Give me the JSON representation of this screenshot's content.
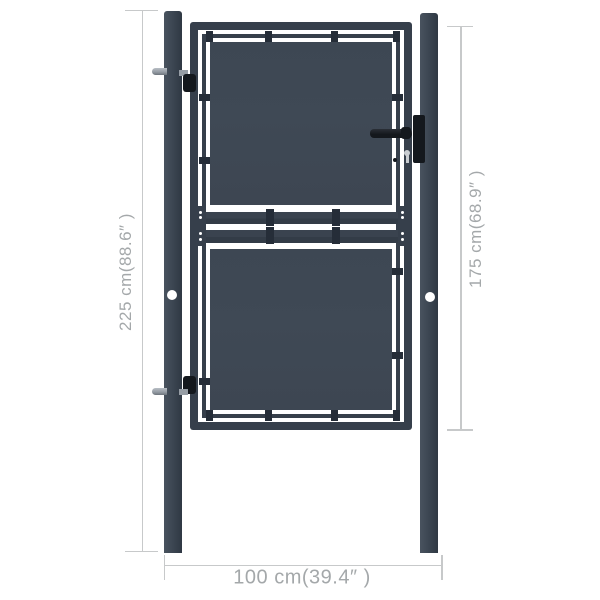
{
  "meta": {
    "subject": "Anthracite metal garden gate with two posts — product dimension diagram"
  },
  "annotations": {
    "total_height": "225 cm(88.6″ )",
    "gate_height": "175 cm(68.9″ )",
    "width": "100 cm(39.4″ )"
  },
  "colors": {
    "background": "#ffffff",
    "frame": "#363f4b",
    "panel": "#3f4955",
    "post_light": "#49535f",
    "post_dark": "#2f3843",
    "clip": "#252d38",
    "hardware_black": "#14181d",
    "hardware_gray": "#969da5",
    "dim_line": "#c7c9ca",
    "dim_text": "#a4a8aa"
  }
}
